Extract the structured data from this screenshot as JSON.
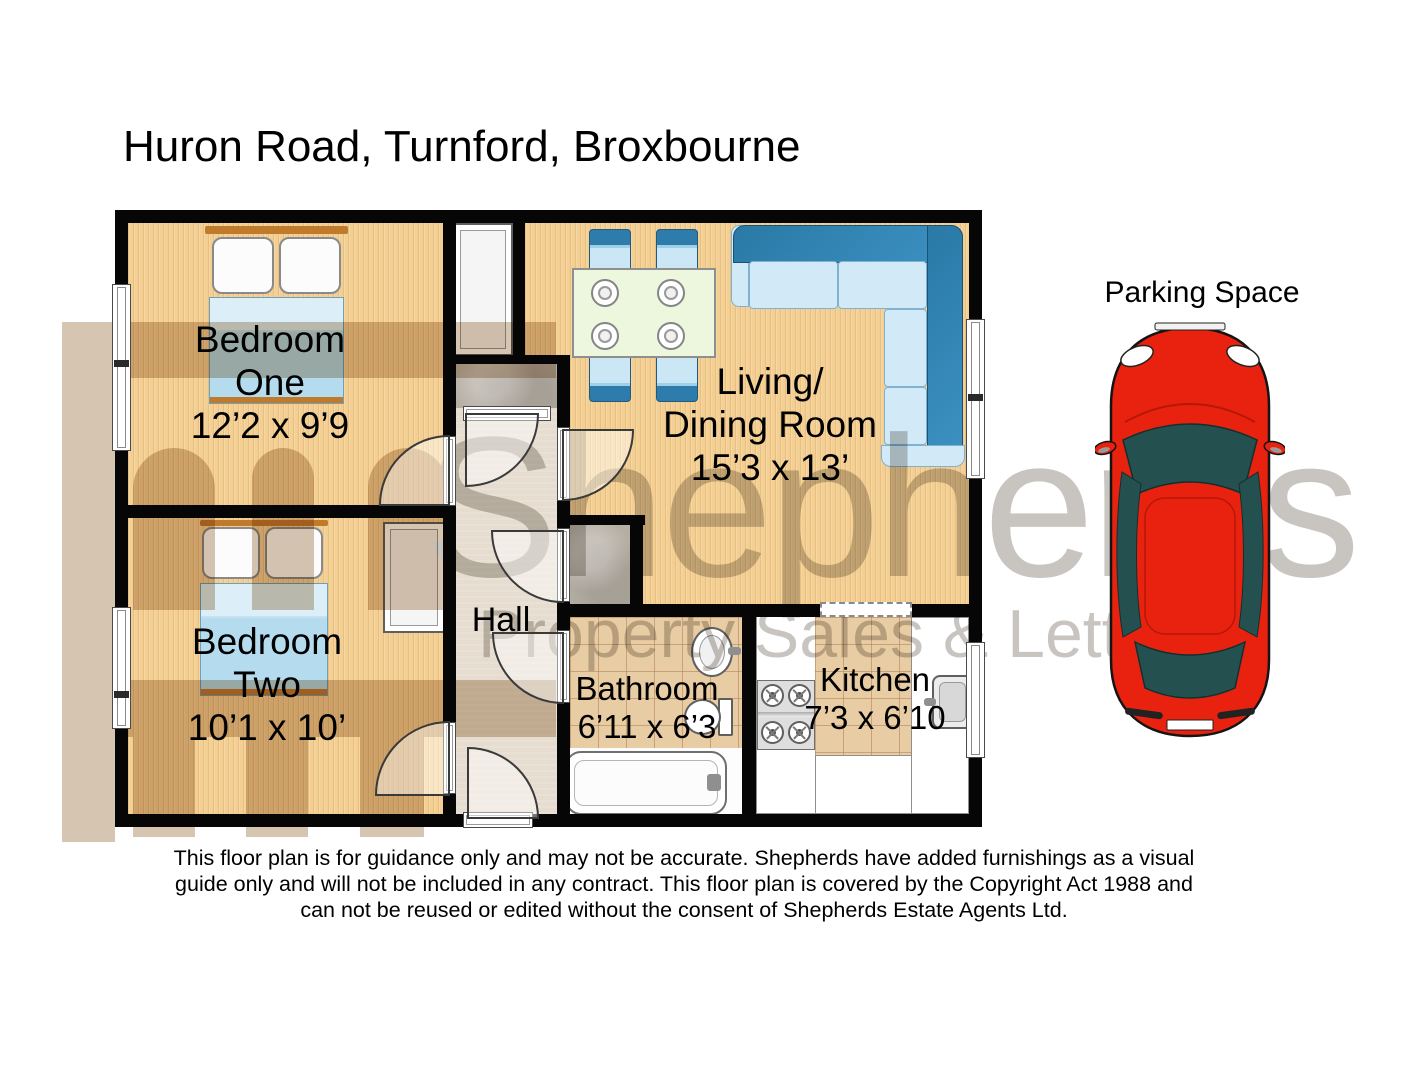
{
  "title": "Huron Road, Turnford, Broxbourne",
  "watermark": {
    "brand": "Shepherds",
    "tagline": "Property Sales & Lettings"
  },
  "parking": {
    "label": "Parking Space"
  },
  "rooms": {
    "bedroom_one": {
      "name_line1": "Bedroom",
      "name_line2": "One",
      "dims": "12’2 x 9’9"
    },
    "bedroom_two": {
      "name_line1": "Bedroom",
      "name_line2": "Two",
      "dims": "10’1 x 10’"
    },
    "living_dining": {
      "name_line1": "Living/",
      "name_line2": "Dining Room",
      "dims": "15’3 x 13’"
    },
    "hall": {
      "name": "Hall"
    },
    "bathroom": {
      "name": "Bathroom",
      "dims": "6’11 x 6’3"
    },
    "kitchen": {
      "name": "Kitchen",
      "dims": "7’3 x 6’10"
    }
  },
  "disclaimer": {
    "line1": "This floor plan is for guidance only and may not be accurate. Shepherds have added furnishings as a visual",
    "line2": "guide only and will not be included in any contract. This floor plan is covered by the Copyright Act 1988 and",
    "line3": "can not be reused or edited without the consent of Shepherds Estate Agents Ltd."
  },
  "colors": {
    "wall": "#060606",
    "wood_floor": "#f3cf94",
    "hall_floor": "#e6ddd0",
    "tile_floor": "#e8cca4",
    "storage_gray": "#b5aea4",
    "bed_blue": "#b5dbee",
    "sofa_dark_blue": "#2d7cab",
    "sofa_light_blue": "#d2eaf8",
    "table_green": "#edf7de",
    "headboard_orange": "#c07a2b",
    "car_red": "#e8220f",
    "car_glass": "#24514f",
    "watermark_gray": "#c8c5c1",
    "logo_tan": "#d6c5b1"
  }
}
